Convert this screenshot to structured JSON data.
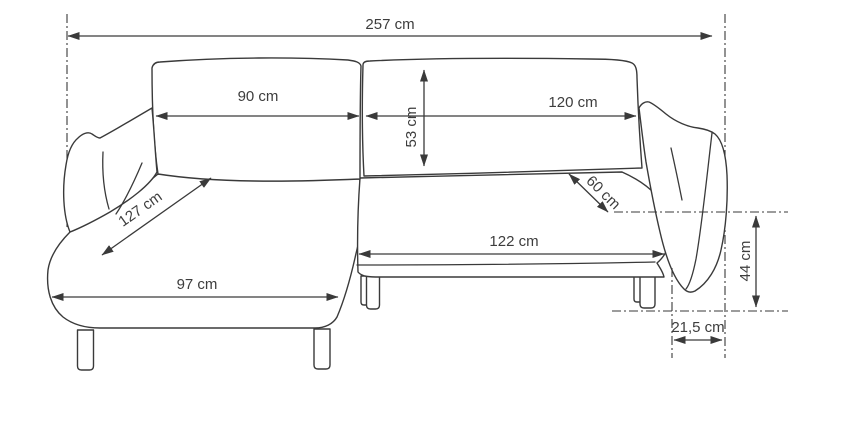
{
  "figure": {
    "title": "corner-sofa-dimension-diagram",
    "unit": "cm",
    "line_color": "#3a3a3a",
    "background_color": "#ffffff",
    "dimensions": {
      "total_width": "257 cm",
      "left_backrest_width": "90 cm",
      "right_backrest_width": "120 cm",
      "backrest_cushion_height": "53 cm",
      "chaise_seat_length": "127 cm",
      "right_seat_depth": "60 cm",
      "right_seat_width": "122 cm",
      "chaise_front_width": "97 cm",
      "armrest_height": "44 cm",
      "armrest_depth": "21,5 cm"
    }
  }
}
